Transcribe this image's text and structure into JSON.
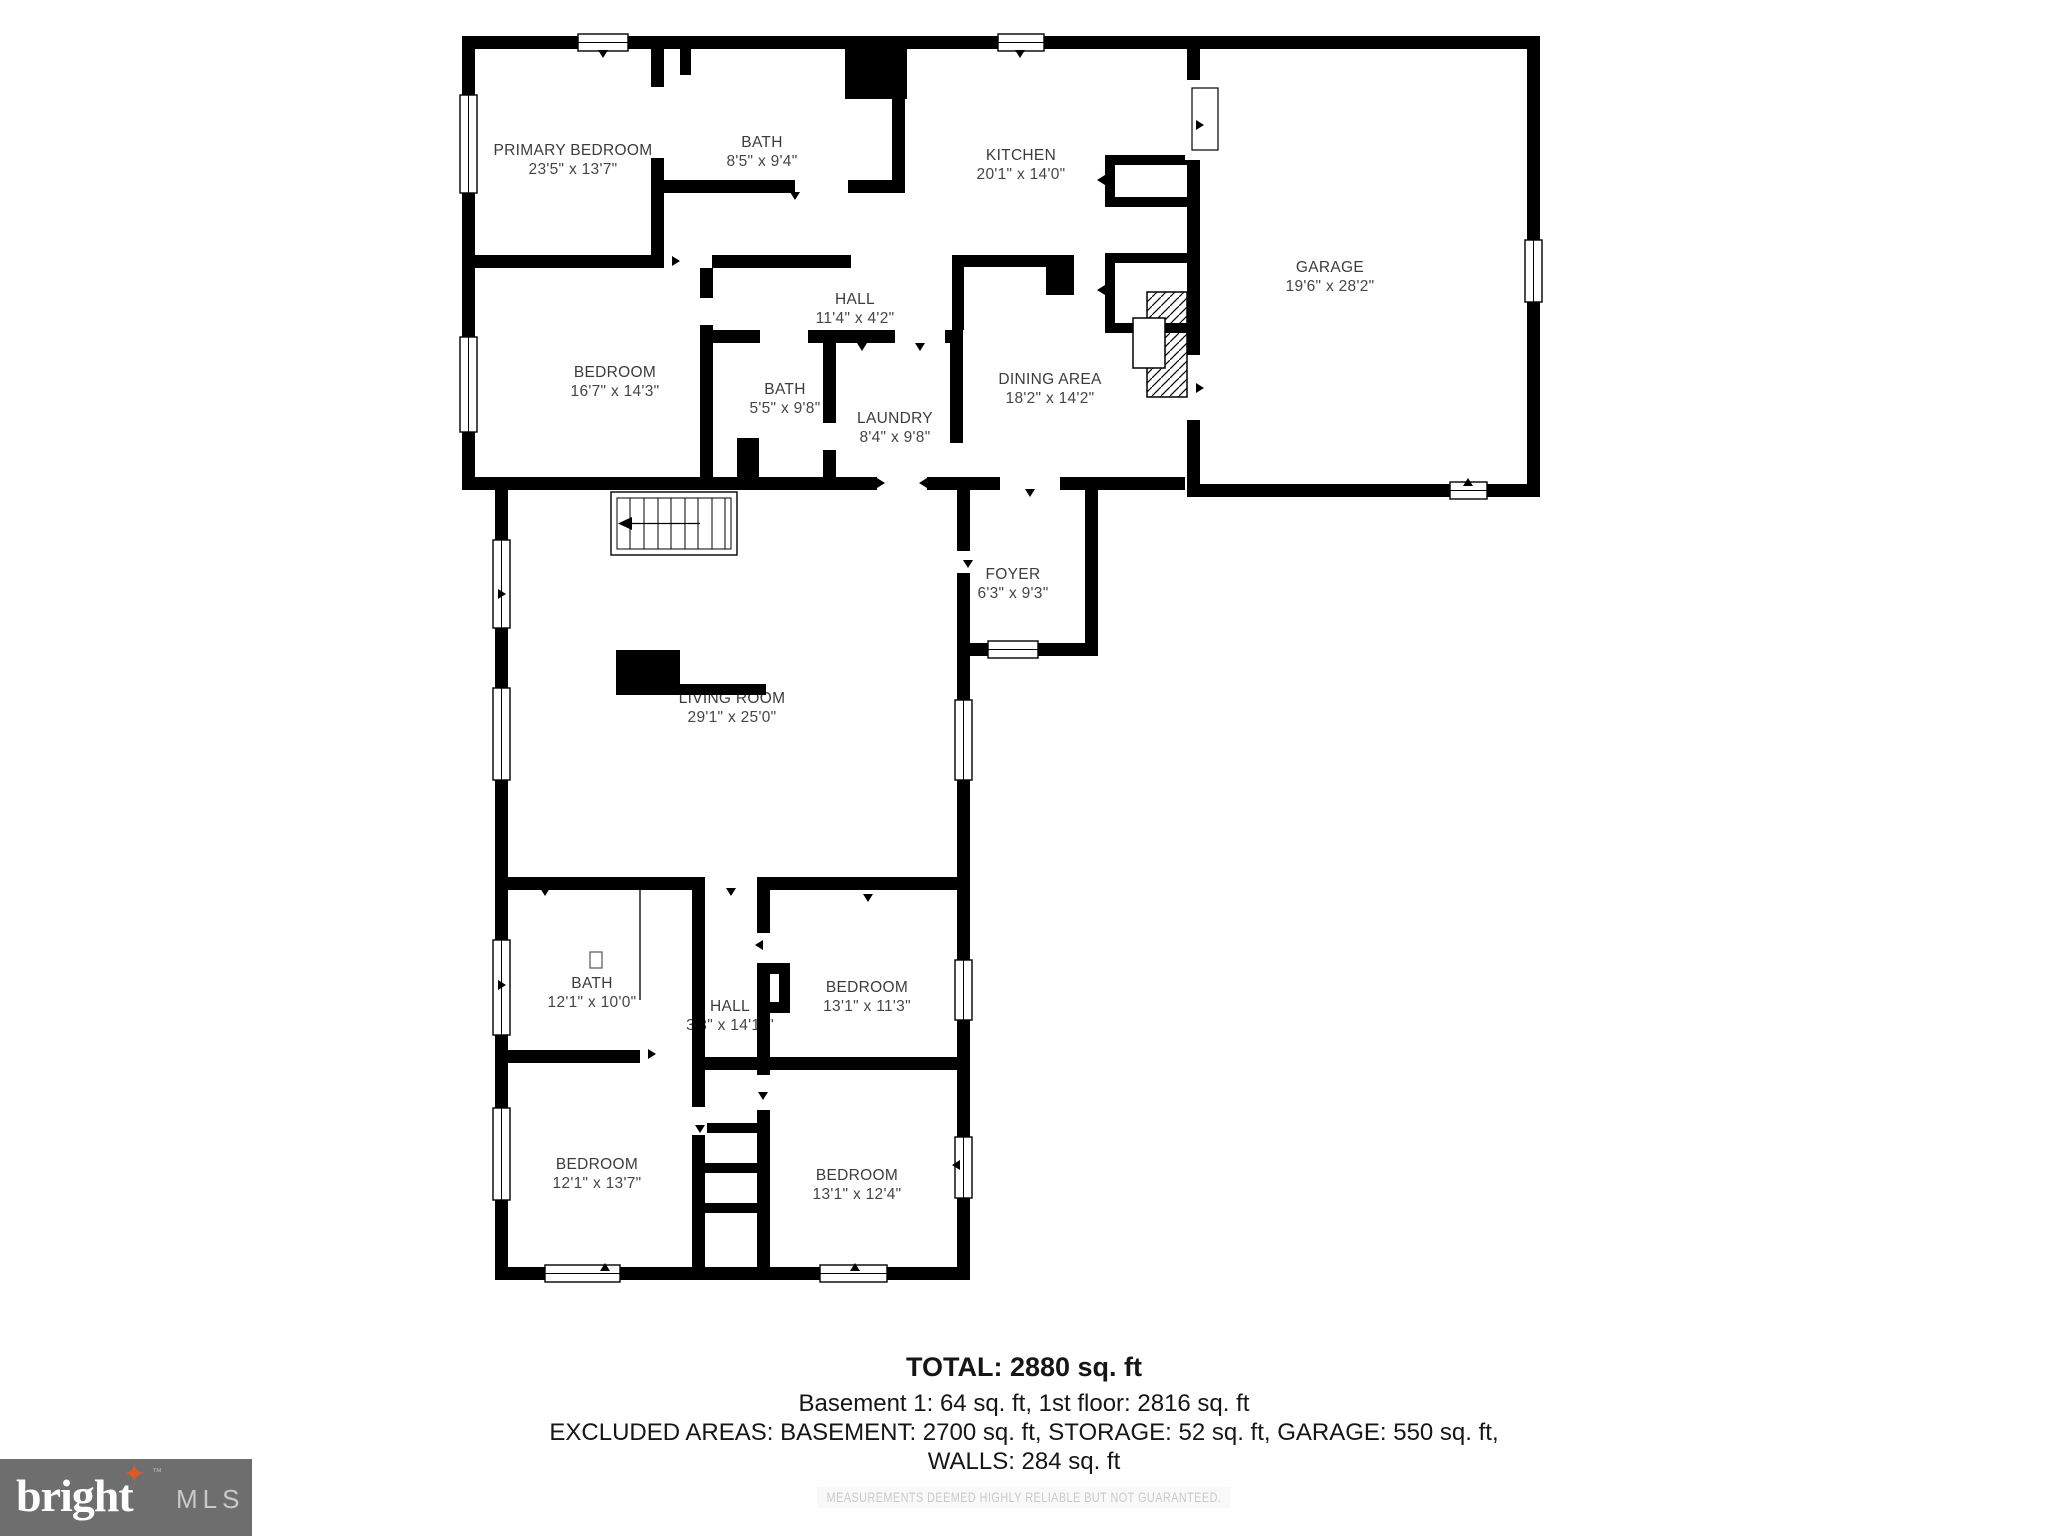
{
  "plan": {
    "rooms": [
      {
        "name": "PRIMARY BEDROOM",
        "dims": "23'5\" x 13'7\""
      },
      {
        "name": "BATH",
        "dims": "8'5\" x 9'4\""
      },
      {
        "name": "KITCHEN",
        "dims": "20'1\" x 14'0\""
      },
      {
        "name": "GARAGE",
        "dims": "19'6\" x 28'2\""
      },
      {
        "name": "HALL",
        "dims": "11'4\" x 4'2\""
      },
      {
        "name": "BEDROOM",
        "dims": "16'7\" x 14'3\""
      },
      {
        "name": "BATH",
        "dims": "5'5\" x 9'8\""
      },
      {
        "name": "LAUNDRY",
        "dims": "8'4\" x 9'8\""
      },
      {
        "name": "DINING AREA",
        "dims": "18'2\" x 14'2\""
      },
      {
        "name": "FOYER",
        "dims": "6'3\" x 9'3\""
      },
      {
        "name": "LIVING ROOM",
        "dims": "29'1\" x 25'0\""
      },
      {
        "name": "BATH",
        "dims": "12'1\" x 10'0\""
      },
      {
        "name": "HALL",
        "dims": "3'3\" x 14'11\""
      },
      {
        "name": "BEDROOM",
        "dims": "13'1\" x 11'3\""
      },
      {
        "name": "BEDROOM",
        "dims": "12'1\" x 13'7\""
      },
      {
        "name": "BEDROOM",
        "dims": "13'1\" x 12'4\""
      }
    ]
  },
  "summary": {
    "total": "TOTAL: 2880 sq. ft",
    "basement_line": "Basement 1: 64 sq. ft, 1st floor: 2816 sq. ft",
    "excluded_line": "EXCLUDED AREAS: BASEMENT: 2700 sq. ft, STORAGE: 52 sq. ft, GARAGE: 550 sq. ft,",
    "walls_line": "WALLS: 284 sq. ft"
  },
  "footer": {
    "disclaimer": "MEASUREMENTS DEEMED HIGHLY RELIABLE BUT NOT GUARANTEED.",
    "logo_brand": "bright",
    "logo_tm": "™",
    "logo_suffix": "MLS"
  },
  "colors": {
    "wall": "#000000",
    "label_text": "#3c3c3c",
    "summary_text": "#161616",
    "disclaimer_text": "#c9c9c9",
    "logo_bg": "#6e6e6e",
    "logo_star": "#d95b2a"
  }
}
